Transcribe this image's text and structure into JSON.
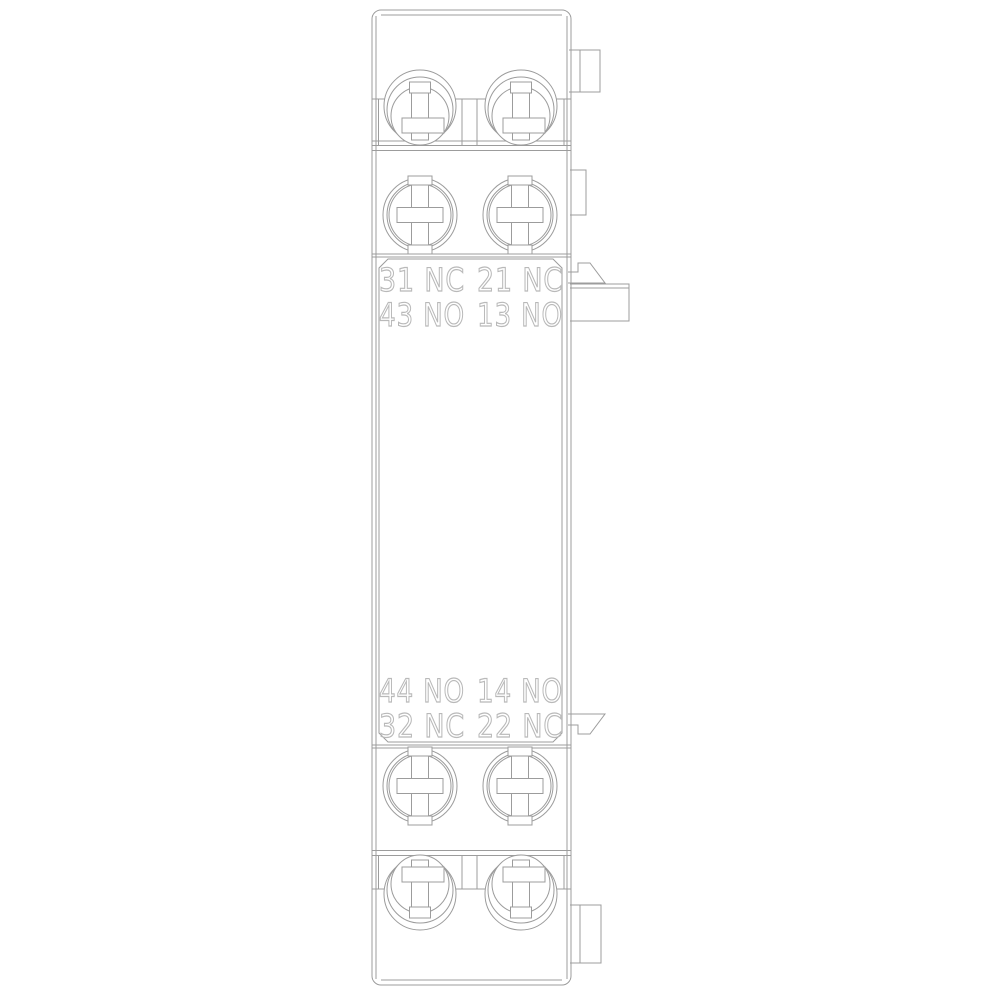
{
  "colors": {
    "line": "#9c9c9c",
    "label": "#b9b9b9",
    "background": "#ffffff"
  },
  "labels": {
    "upper": [
      [
        "31 NC",
        "21 NC"
      ],
      [
        "43 NO",
        "13 NO"
      ]
    ],
    "lower": [
      [
        "44 NO",
        "14 NO"
      ],
      [
        "32 NC",
        "22 NC"
      ]
    ]
  },
  "icons": {
    "screw": "screw-terminal-icon",
    "arrow": "slide-direction-arrow-icon",
    "tab": "mounting-tab-icon",
    "plate": "mounting-plate-icon"
  }
}
